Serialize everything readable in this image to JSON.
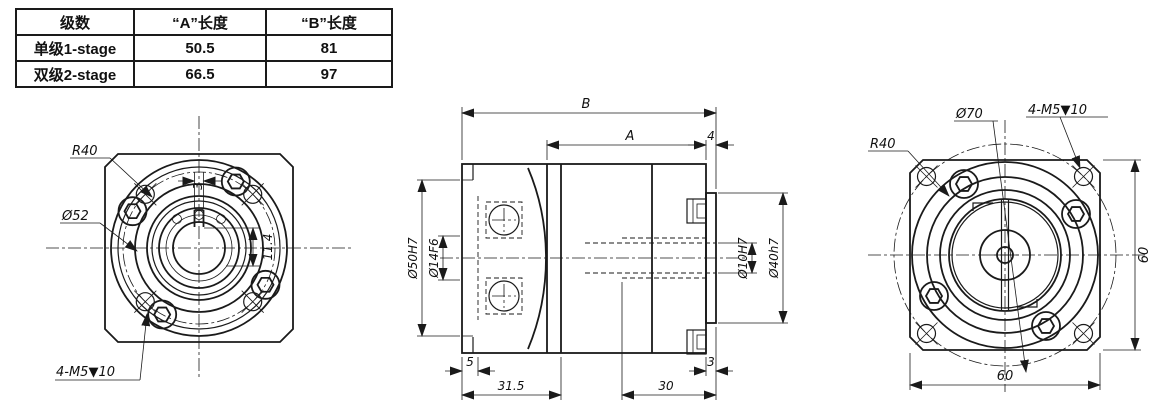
{
  "colors": {
    "line": "#1a1a1a",
    "background": "#ffffff"
  },
  "table": {
    "headers": [
      "级数",
      "“A”长度",
      "“B”长度"
    ],
    "rows": [
      {
        "stage": "单级1-stage",
        "a": "50.5",
        "b": "81"
      },
      {
        "stage": "双级2-stage",
        "a": "66.5",
        "b": "97"
      }
    ]
  },
  "front_view": {
    "radius_label": "R40",
    "bore_label": "Ø52",
    "tapped_holes_label": "4-M5▼10",
    "keyway_width": "3",
    "keyway_height": "11.4"
  },
  "side_view": {
    "dim_b": "B",
    "dim_a": "A",
    "dim_4": "4",
    "bore_left_outer": "Ø50H7",
    "bore_left_inner": "Ø14F6",
    "bore_right_inner": "Ø10H7",
    "pilot_right": "Ø40h7",
    "dim_5": "5",
    "dim_31_5": "31.5",
    "dim_30": "30",
    "dim_3": "3"
  },
  "rear_view": {
    "radius_label": "R40",
    "pilot_label": "Ø70",
    "tapped_holes_label": "4-M5▼10",
    "width_60": "60",
    "height_60": "60"
  }
}
